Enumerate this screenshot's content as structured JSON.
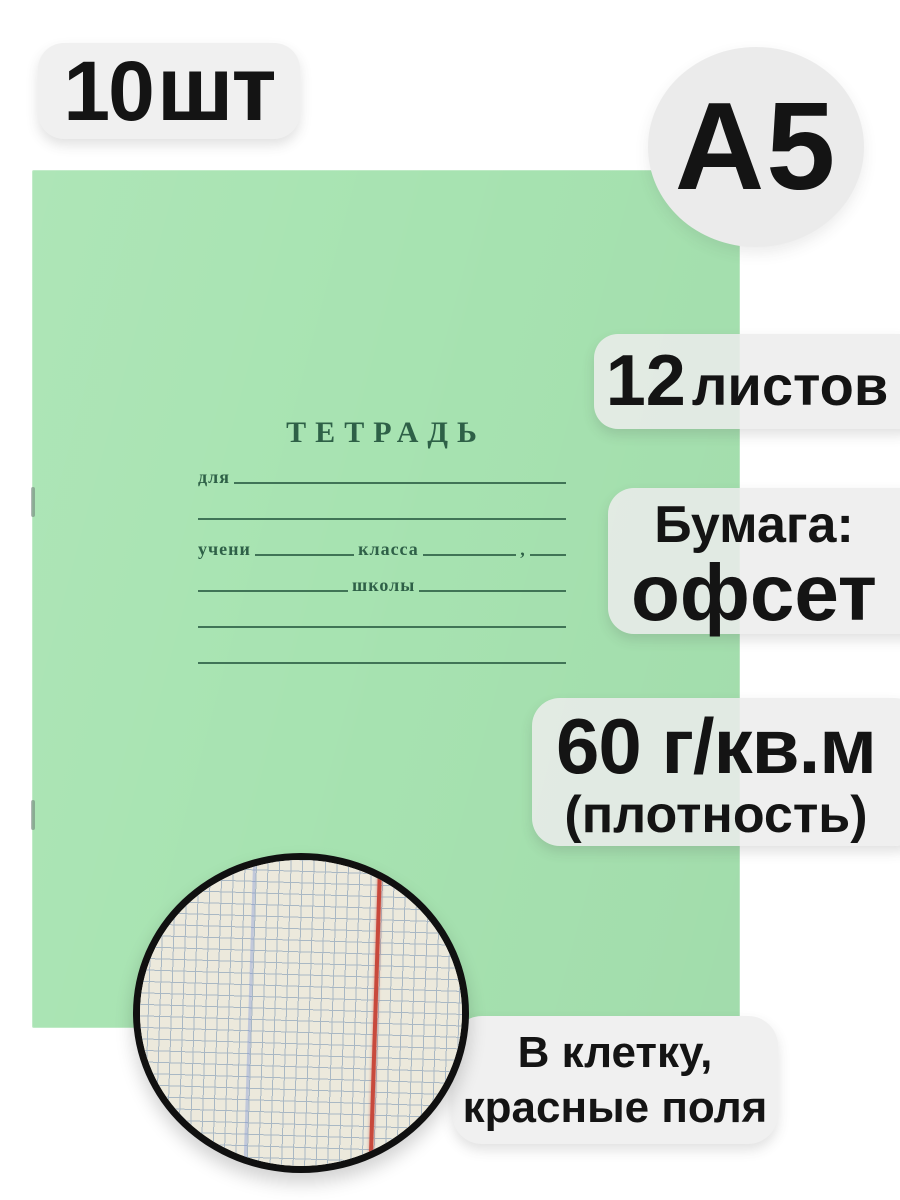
{
  "colors": {
    "cover_green": "#a7e3b1",
    "print_green": "#2e6047",
    "badge_bg": "#f0f0f0",
    "badge_translucent": "rgba(236,236,236,0.85)",
    "text_black": "#141414",
    "inset_paper": "#ece9dc",
    "inset_grid": "#a9b8c4",
    "inset_margin_red": "#c8493c",
    "inset_crease_blue": "rgba(130,150,215,0.4)",
    "inset_ring": "#101010"
  },
  "badges": {
    "quantity": {
      "value": "10",
      "unit": "шт"
    },
    "format": "A5",
    "sheets": {
      "value": "12",
      "unit": "листов"
    },
    "paper": {
      "label": "Бумага:",
      "value": "офсет"
    },
    "density": {
      "value": "60 г/кв.м",
      "note": "(плотность)"
    },
    "ruling": {
      "line1": "В клетку,",
      "line2": "красные поля"
    }
  },
  "notebook": {
    "title": "ТЕТРАДЬ",
    "fields": {
      "for_label": "для",
      "student_label": "учени",
      "class_label": "класса",
      "separator": ",",
      "school_label": "школы"
    }
  }
}
